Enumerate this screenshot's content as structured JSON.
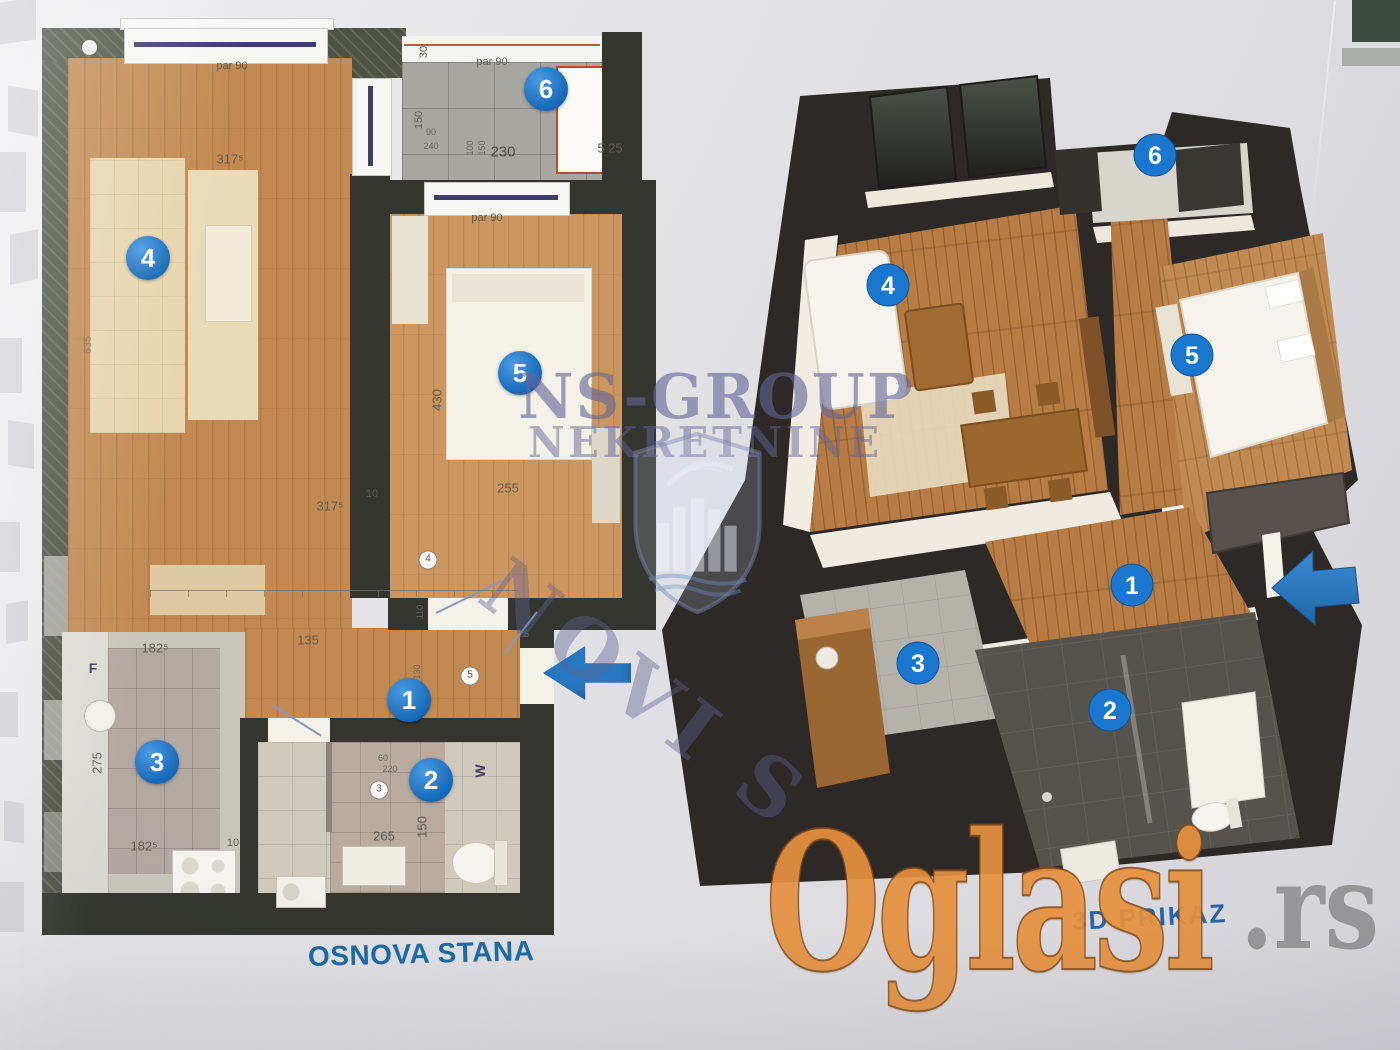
{
  "markers": [
    "1",
    "2",
    "3",
    "4",
    "5",
    "6"
  ],
  "floorplan": {
    "title": "OSNOVA STANA",
    "dims": [
      "par 90",
      "317⁵",
      "30",
      "par 90",
      "150",
      "90",
      "240",
      "230",
      "100",
      "150",
      "5  25",
      "par 90",
      "635",
      "430",
      "255",
      "317⁵",
      "10",
      "110",
      "25",
      "135",
      "130",
      "182⁵",
      "F",
      "275",
      "182⁵",
      "10",
      "60",
      "220",
      "265",
      "150",
      "W"
    ],
    "circled": [
      "3",
      "4",
      "5"
    ]
  },
  "render3d": {
    "title": "3D PRIKAZ"
  },
  "watermarks": {
    "agency_line1": "NS-GROUP",
    "agency_line2": "NEKRETNINE",
    "agency_diagonal": "NOVI S",
    "site_name": "Oglasi",
    "site_suffix": ".rs"
  },
  "colors": {
    "badge_blue": "#1977cf",
    "title_blue": "#1b6aa6",
    "oglasi_orange": "#e6913f",
    "arrow_blue": "#2878c0"
  }
}
